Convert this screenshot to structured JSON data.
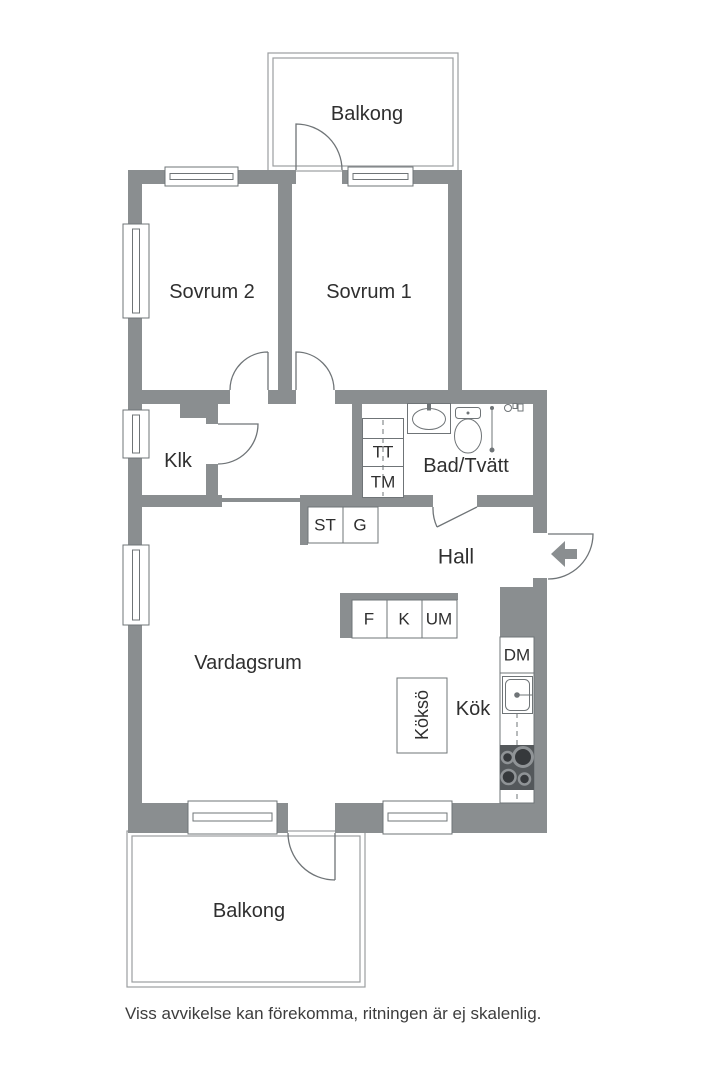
{
  "rooms": {
    "balkong_top": "Balkong",
    "sovrum2": "Sovrum 2",
    "sovrum1": "Sovrum 1",
    "klk": "Klk",
    "bad_tvatt": "Bad/Tvätt",
    "hall": "Hall",
    "vardagsrum": "Vardagsrum",
    "koks_island": "Köksö",
    "kok": "Kök",
    "balkong_bottom": "Balkong"
  },
  "appliances": {
    "tt": "TT",
    "tm": "TM",
    "st": "ST",
    "g": "G",
    "f": "F",
    "k": "K",
    "um": "UM",
    "dm": "DM"
  },
  "footer": "Viss avvikelse kan förekomma, ritningen är ej skalenlig.",
  "colors": {
    "wall": "#8a8e90",
    "line": "#6f7477",
    "text": "#2f2f2f"
  }
}
